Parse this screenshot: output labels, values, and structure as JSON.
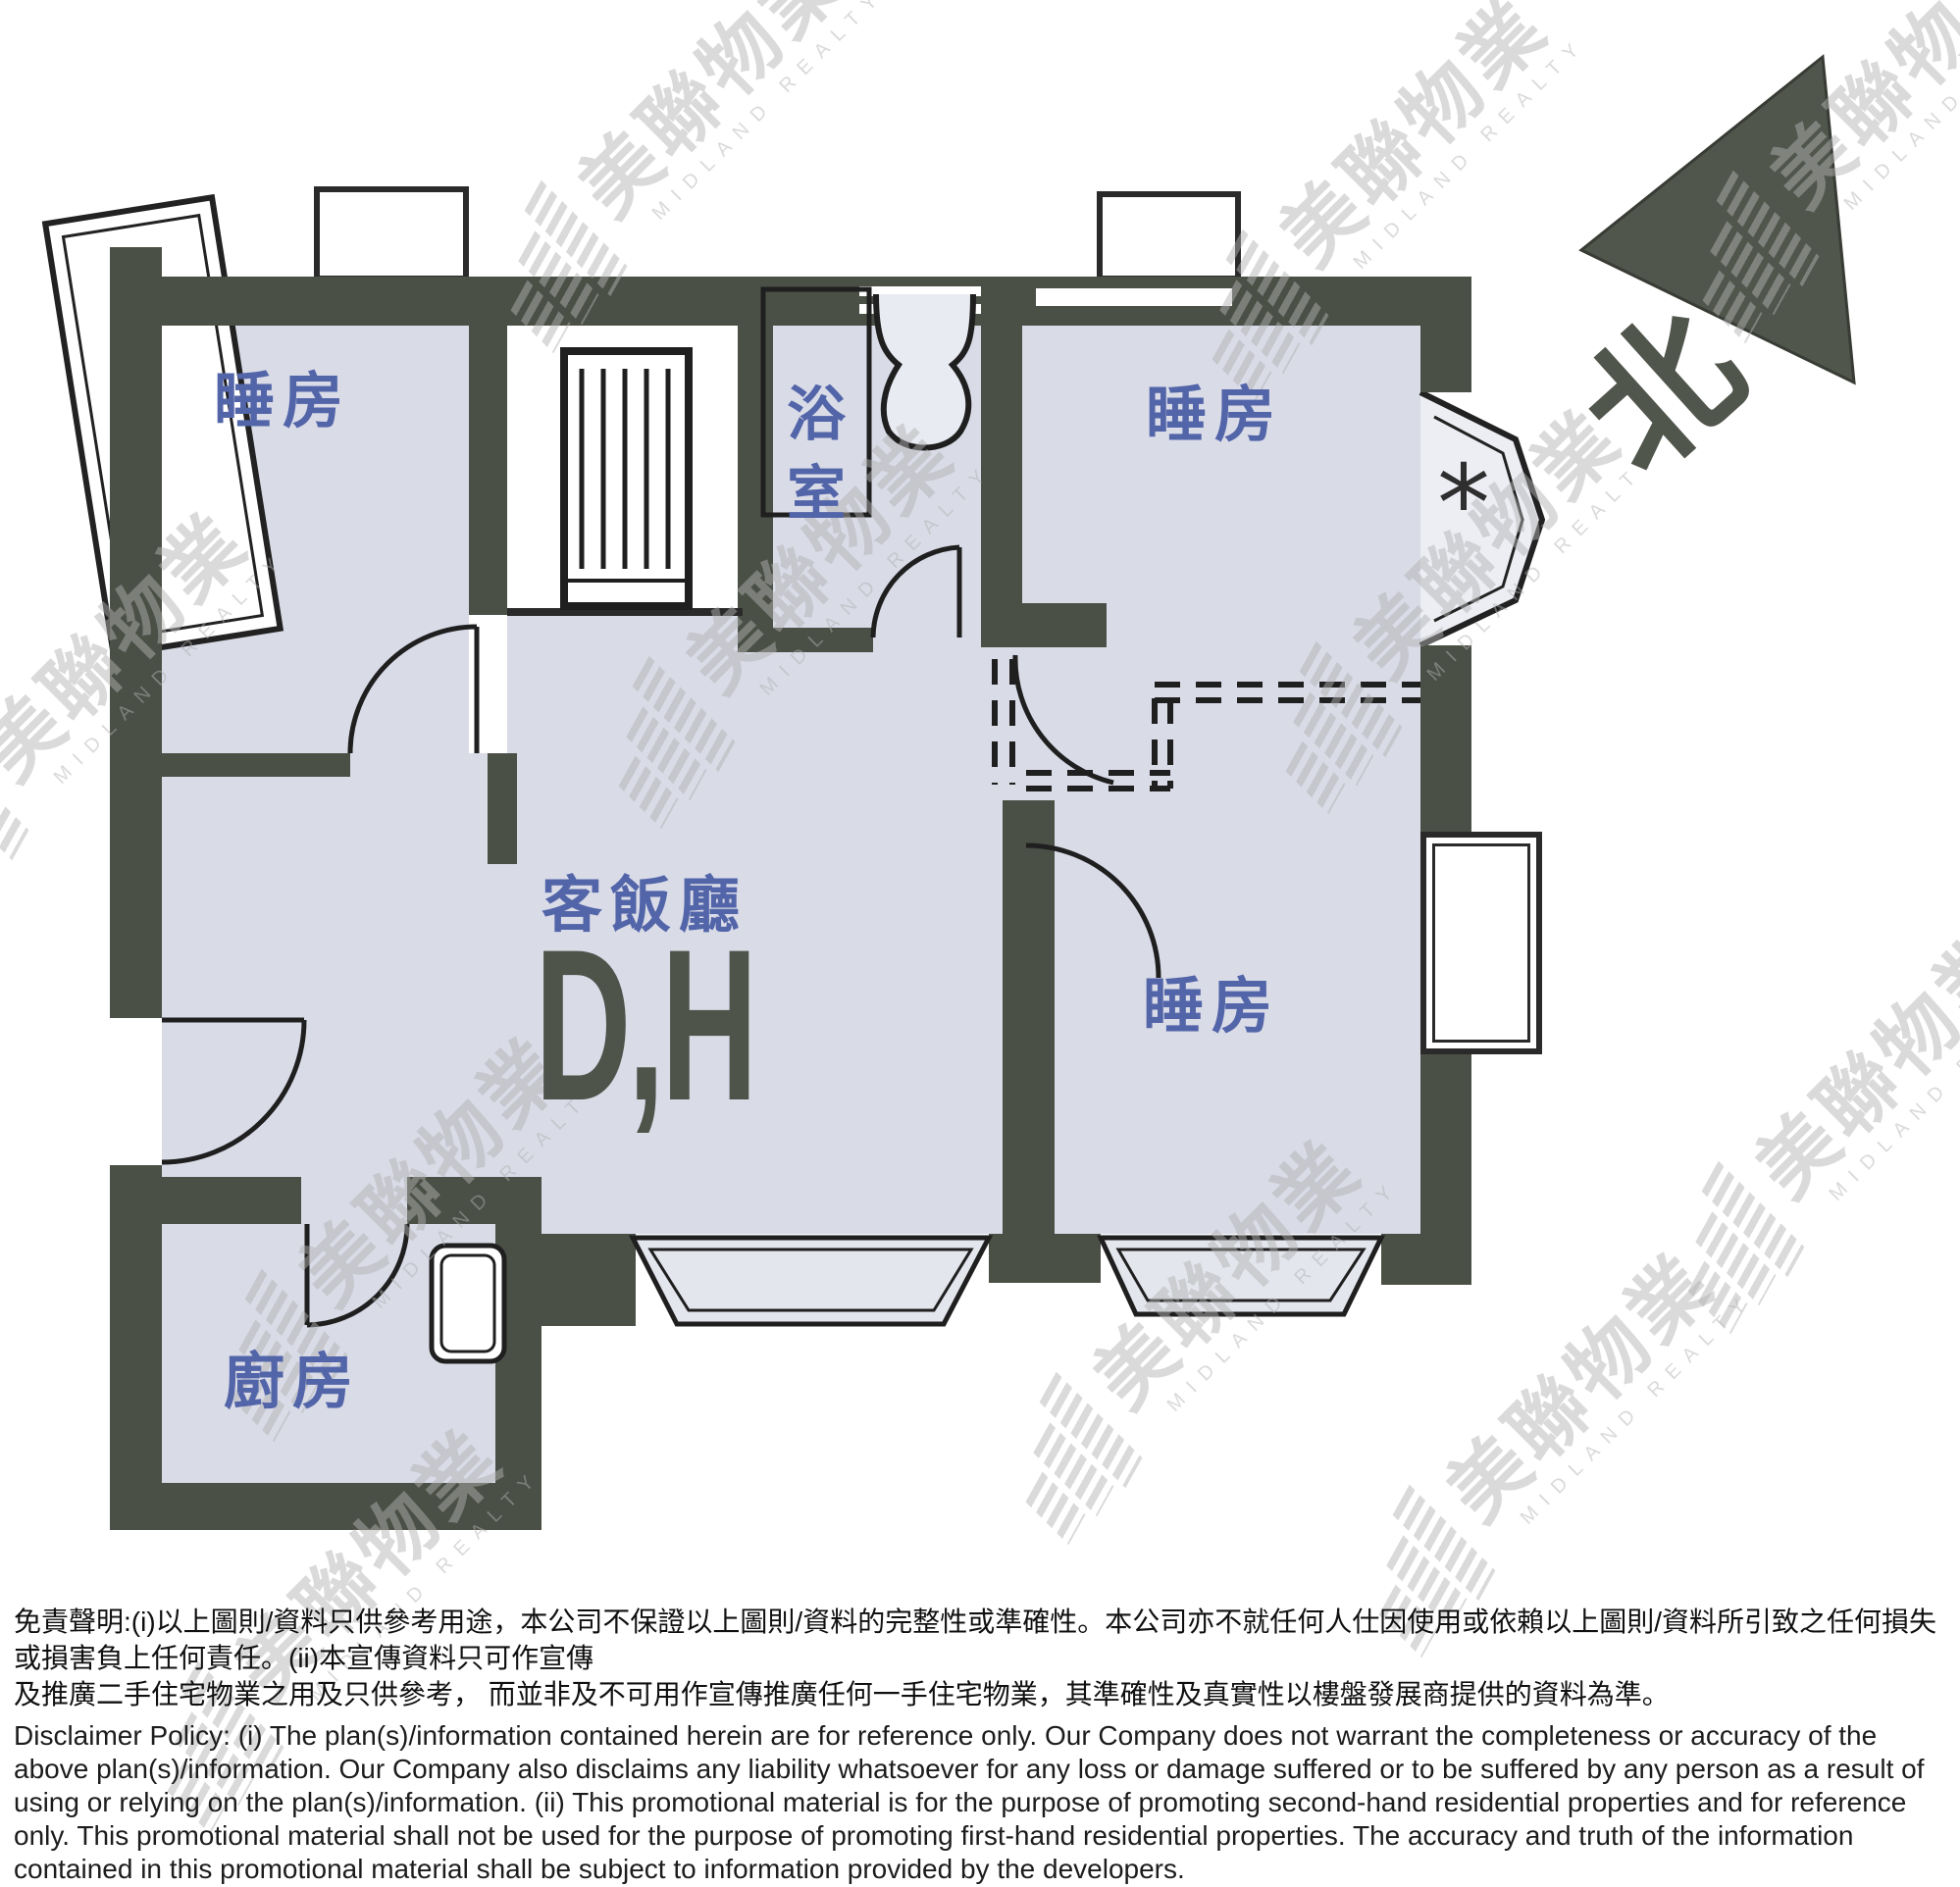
{
  "document": {
    "kind": "residential floor plan leaflet",
    "brand": "Midland Realty"
  },
  "colors": {
    "wall": "#4b5046",
    "fill": "#d9dbe7",
    "bayfill": "#e4e6ee",
    "line": "#1f1f1f",
    "label": "#5365a9",
    "dh": "#4e544a",
    "wm": "#b2b2b2",
    "compass": "#51564c"
  },
  "watermark": {
    "cjk": "美聯物業",
    "latin": "MIDLAND REALTY",
    "positions": [
      [
        715,
        115
      ],
      [
        1430,
        165
      ],
      [
        1930,
        105
      ],
      [
        105,
        690
      ],
      [
        825,
        600
      ],
      [
        1505,
        585
      ],
      [
        430,
        1225
      ],
      [
        1240,
        1330
      ],
      [
        1915,
        1115
      ],
      [
        365,
        1625
      ],
      [
        1600,
        1445
      ]
    ]
  },
  "plan": {
    "rooms": {
      "bedroom_top_left": "睡房",
      "bedroom_top_right": "睡房",
      "bedroom_bottom_right": "睡房",
      "bathroom": "浴室",
      "living_dining": "客飯廳",
      "living_dining_code": "D,H",
      "kitchen": "廚房"
    },
    "compass_north": "北",
    "window_marker": "*"
  },
  "disclaimer": {
    "zh_line1": "免責聲明:(i)以上圖則/資料只供參考用途，本公司不保證以上圖則/資料的完整性或準確性。本公司亦不就任何人仕因使用或依賴以上圖則/資料所引致之任何損失或損害負上任何責任。(ii)本宣傳資料只可作宣傳",
    "zh_line2": "及推廣二手住宅物業之用及只供參考，  而並非及不可用作宣傳推廣任何一手住宅物業，其準確性及真實性以樓盤發展商提供的資料為準。",
    "en": "Disclaimer Policy: (i) The plan(s)/information contained herein are for reference only. Our Company does not warrant the completeness or accuracy of the above plan(s)/information. Our Company also disclaims any liability whatsoever for any loss or damage suffered or to be suffered by any person as a result of using or relying on the plan(s)/information. (ii) This promotional material is for the purpose of promoting second-hand residential properties and for reference only. This promotional material shall not be used for the purpose of promoting first-hand residential properties. The accuracy and truth of the information contained in this promotional material shall be subject to information provided by the developers."
  }
}
